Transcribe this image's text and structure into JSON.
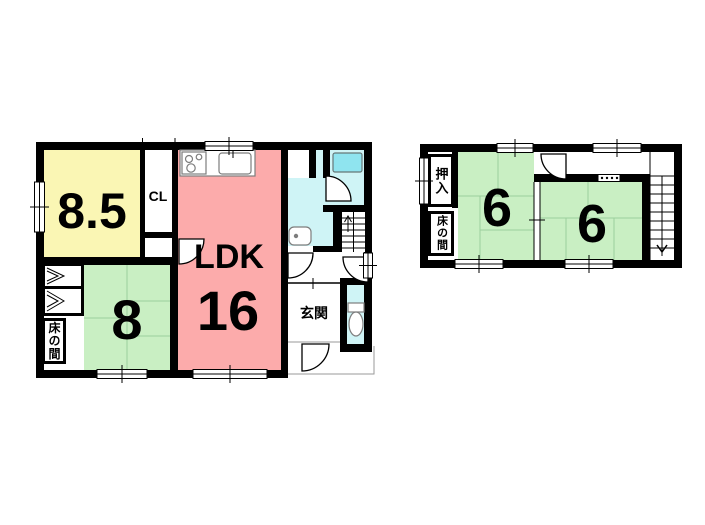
{
  "colors": {
    "wall": "#000000",
    "room_yellow": "#FAF6B4",
    "room_pink": "#FCABAB",
    "tatami_green": "#C9EFC3",
    "water_cyan": "#CFF4F6",
    "bathtub_cyan": "#8FE4EF"
  },
  "floor1": {
    "western_room_size": "8.5",
    "closet_label": "CL",
    "ldk_label": "LDK",
    "ldk_size": "16",
    "japanese_room_size": "8",
    "entrance_label": "玄関",
    "tokonoma_label": "床の間"
  },
  "floor2": {
    "room_a_size": "6",
    "room_b_size": "6",
    "oshiire_label": "押入",
    "tokonoma_label": "床の間"
  }
}
